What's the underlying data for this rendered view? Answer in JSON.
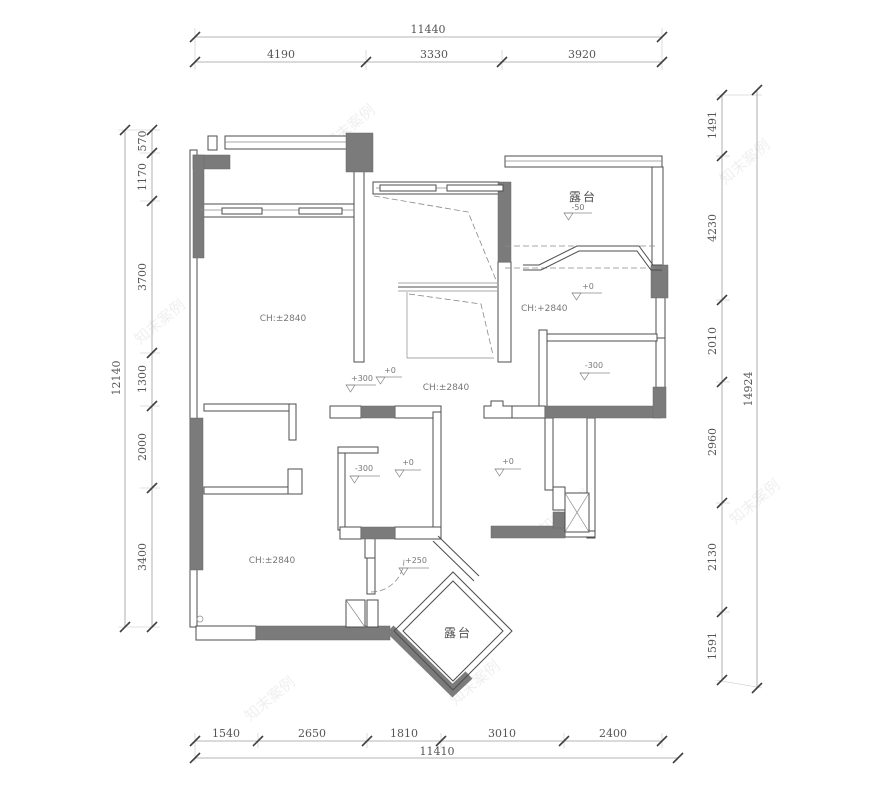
{
  "dims": {
    "top": {
      "total": "11440",
      "seg": [
        "4190",
        "3330",
        "3920"
      ]
    },
    "bottom": {
      "total": "11410",
      "seg": [
        "1540",
        "2650",
        "1810",
        "3010",
        "2400"
      ]
    },
    "left": {
      "total": "12140",
      "seg": [
        "570",
        "1170",
        "3700",
        "1300",
        "2000",
        "3400"
      ]
    },
    "right": {
      "total": "14924",
      "seg": [
        "1491",
        "4230",
        "2010",
        "2960",
        "2130",
        "1591"
      ]
    }
  },
  "labels": {
    "terrace_top": "露台",
    "terrace_bottom": "露台",
    "ch_top_left": "CH:±2840",
    "ch_center": "CH:±2840",
    "ch_right": "CH:+2840",
    "ch_bottom_left": "CH:±2840"
  },
  "levels": {
    "minus50": "-50",
    "plus0": "+0",
    "plus300": "+300",
    "minus300": "-300",
    "plus250": "+250"
  },
  "watermark": "知末案例",
  "colors": {
    "wall_gray": "#7b7b7b",
    "line": "#4d4d4d",
    "dimension": "#9b9b9b",
    "background": "#ffffff"
  }
}
